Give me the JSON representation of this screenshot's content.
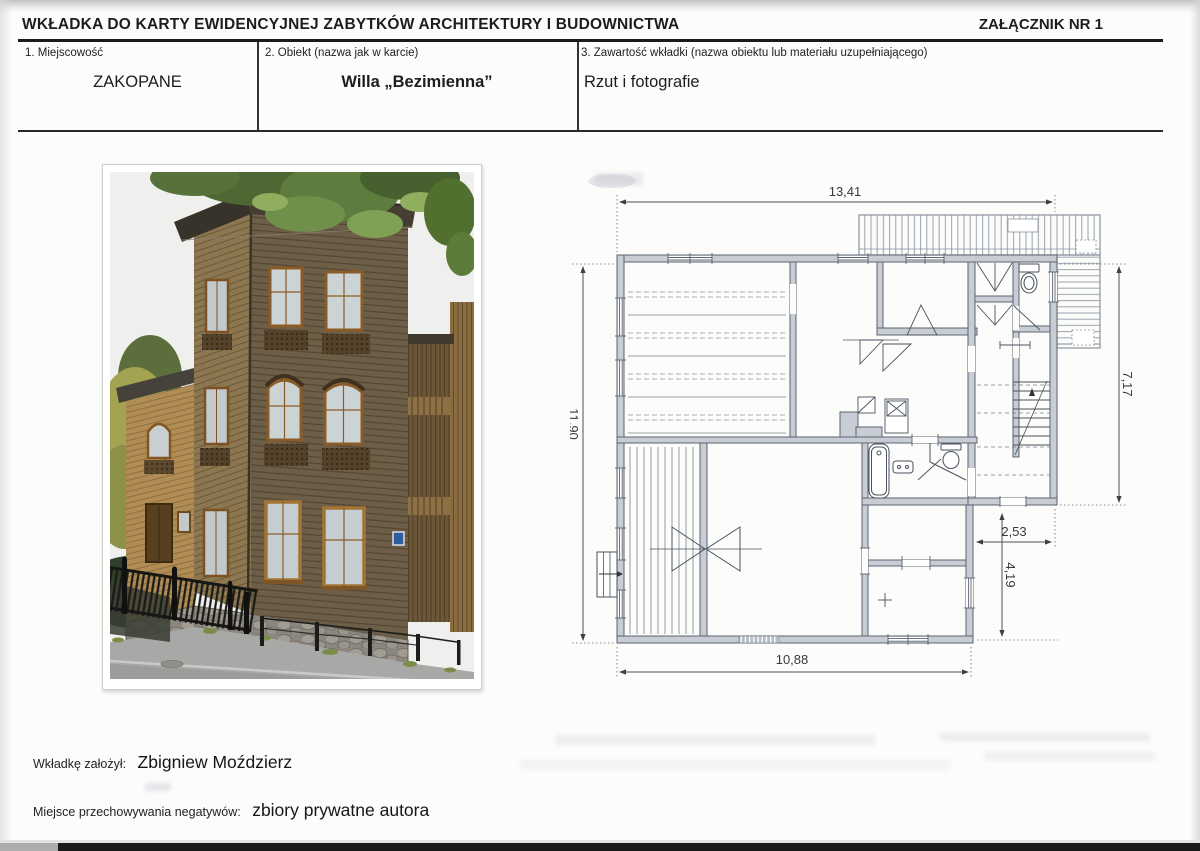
{
  "document": {
    "header": {
      "title": "WKŁADKA DO KARTY EWIDENCYJNEJ ZABYTKÓW ARCHITEKTURY I BUDOWNICTWA",
      "attachment": "ZAŁĄCZNIK NR 1"
    },
    "fields": {
      "f1": {
        "label": "1. Miejscowość",
        "value": "ZAKOPANE"
      },
      "f2": {
        "label": "2. Obiekt (nazwa jak w karcie)",
        "value": "Willa „Bezimienna”"
      },
      "f3": {
        "label": "3. Zawartość wkładki (nazwa obiektu lub materiału uzupełniającego)",
        "value": "Rzut i fotografie"
      }
    },
    "plan": {
      "dim_top": "13,41",
      "dim_left": "11,90",
      "dim_right": "7,17",
      "dim_inner_width": "2,53",
      "dim_inner_height": "4,19",
      "dim_bottom": "10,88"
    },
    "footer": {
      "founder_label": "Wkładkę założył:",
      "founder_name": "Zbigniew Moździerz",
      "negatives_label": "Miejsce przechowywania negatywów:",
      "negatives_value": "zbiory prywatne autora"
    }
  }
}
